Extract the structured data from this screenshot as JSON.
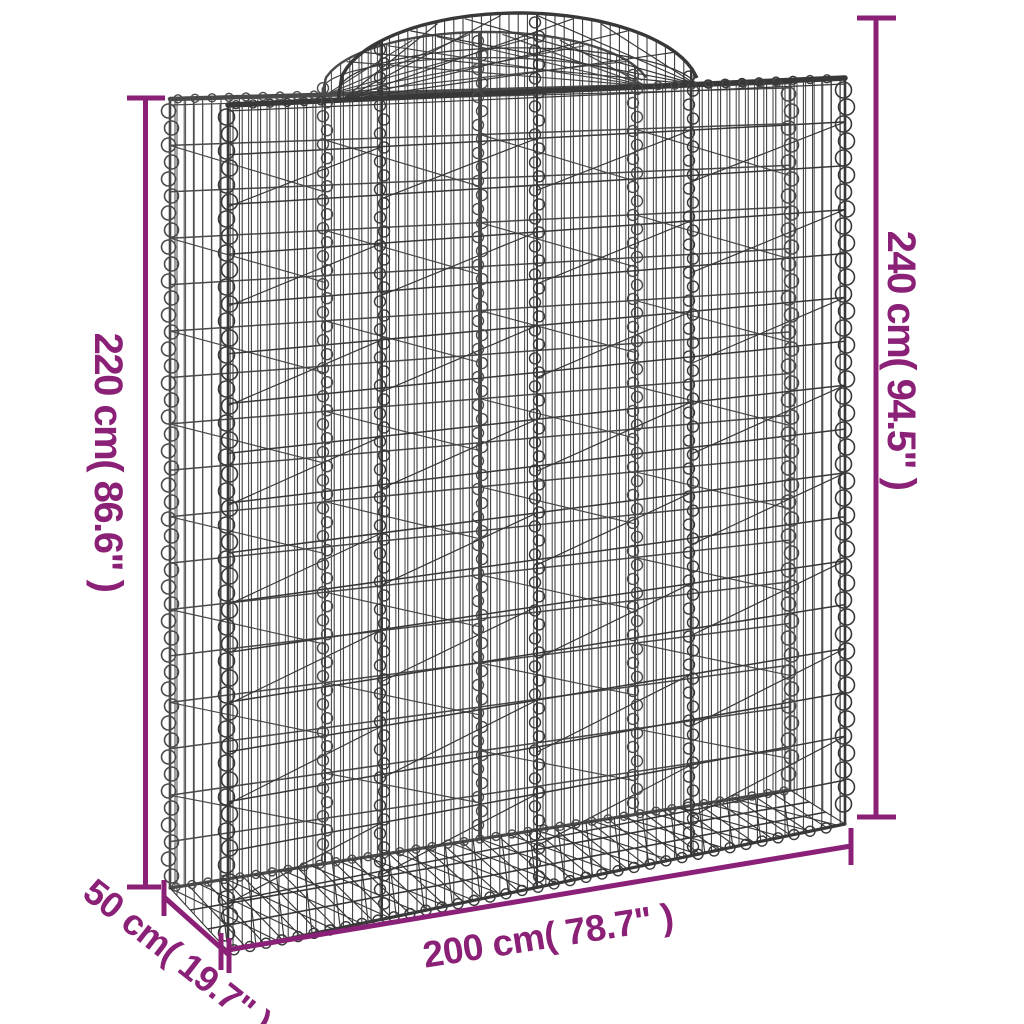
{
  "diagram": {
    "subject": "arched gabion basket wire-mesh product dimension diagram"
  },
  "colors": {
    "dimension": "#8b2077",
    "wire_front": "#383838",
    "wire_back": "#4a4a4a",
    "background": "#ffffff"
  },
  "dimensions": {
    "height_left": {
      "label": "220 cm( 86.6\" )",
      "cm": 220,
      "inches": 86.6
    },
    "height_right": {
      "label": "240 cm( 94.5\" )",
      "cm": 240,
      "inches": 94.5
    },
    "width_bottom": {
      "label": "200 cm( 78.7\" )",
      "cm": 200,
      "inches": 78.7
    },
    "depth_bottom_left": {
      "label": "50 cm( 19.7\" )",
      "cm": 50,
      "inches": 19.7
    }
  }
}
